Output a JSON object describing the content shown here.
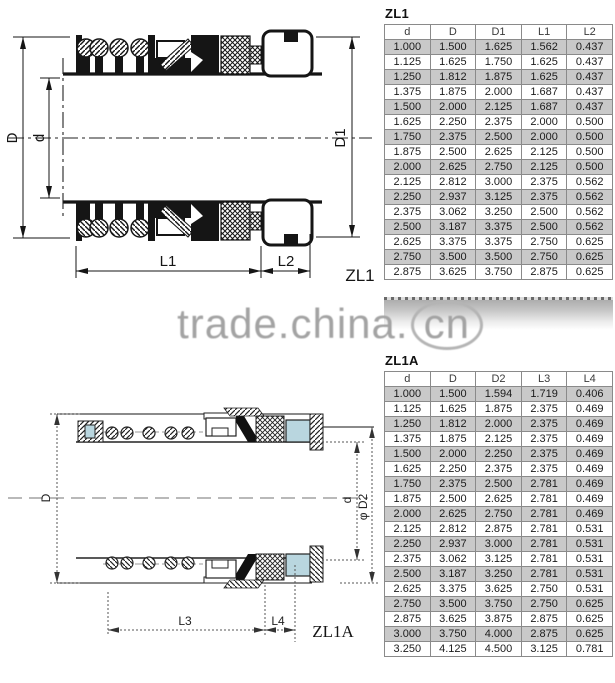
{
  "watermark": {
    "prefix": "trade.china.",
    "suffix": "cn"
  },
  "colors": {
    "row_shade": "#c9c9c9",
    "table_border": "#8a8a8a",
    "seat_blue": "#b9d6df",
    "watermark_gray": "#a3a3a3",
    "line_black": "#151515"
  },
  "zl1": {
    "title": "ZL1",
    "drawing": {
      "label": "ZL1",
      "dim_outer_diameter": "D",
      "dim_shaft_diameter": "d",
      "dim_seat_diameter": "D1",
      "dim_length1": "L1",
      "dim_length2": "L2"
    },
    "table": {
      "headers": [
        "d",
        "D",
        "D1",
        "L1",
        "L2"
      ],
      "rows": [
        [
          "1.000",
          "1.500",
          "1.625",
          "1.562",
          "0.437"
        ],
        [
          "1.125",
          "1.625",
          "1.750",
          "1.625",
          "0.437"
        ],
        [
          "1.250",
          "1.812",
          "1.875",
          "1.625",
          "0.437"
        ],
        [
          "1.375",
          "1.875",
          "2.000",
          "1.687",
          "0.437"
        ],
        [
          "1.500",
          "2.000",
          "2.125",
          "1.687",
          "0.437"
        ],
        [
          "1.625",
          "2.250",
          "2.375",
          "2.000",
          "0.500"
        ],
        [
          "1.750",
          "2.375",
          "2.500",
          "2.000",
          "0.500"
        ],
        [
          "1.875",
          "2.500",
          "2.625",
          "2.125",
          "0.500"
        ],
        [
          "2.000",
          "2.625",
          "2.750",
          "2.125",
          "0.500"
        ],
        [
          "2.125",
          "2.812",
          "3.000",
          "2.375",
          "0.562"
        ],
        [
          "2.250",
          "2.937",
          "3.125",
          "2.375",
          "0.562"
        ],
        [
          "2.375",
          "3.062",
          "3.250",
          "2.500",
          "0.562"
        ],
        [
          "2.500",
          "3.187",
          "3.375",
          "2.500",
          "0.562"
        ],
        [
          "2.625",
          "3.375",
          "3.375",
          "2.750",
          "0.625"
        ],
        [
          "2.750",
          "3.500",
          "3.500",
          "2.750",
          "0.625"
        ],
        [
          "2.875",
          "3.625",
          "3.750",
          "2.875",
          "0.625"
        ]
      ]
    }
  },
  "zl1a": {
    "title": "ZL1A",
    "drawing": {
      "label": "ZL1A",
      "dim_outer_diameter": "D",
      "dim_shaft_diameter": "d",
      "dim_seat_diameter": "φ D2",
      "dim_length3": "L3",
      "dim_length4": "L4"
    },
    "table": {
      "headers": [
        "d",
        "D",
        "D2",
        "L3",
        "L4"
      ],
      "rows": [
        [
          "1.000",
          "1.500",
          "1.594",
          "1.719",
          "0.406"
        ],
        [
          "1.125",
          "1.625",
          "1.875",
          "2.375",
          "0.469"
        ],
        [
          "1.250",
          "1.812",
          "2.000",
          "2.375",
          "0.469"
        ],
        [
          "1.375",
          "1.875",
          "2.125",
          "2.375",
          "0.469"
        ],
        [
          "1.500",
          "2.000",
          "2.250",
          "2.375",
          "0.469"
        ],
        [
          "1.625",
          "2.250",
          "2.375",
          "2.375",
          "0.469"
        ],
        [
          "1.750",
          "2.375",
          "2.500",
          "2.781",
          "0.469"
        ],
        [
          "1.875",
          "2.500",
          "2.625",
          "2.781",
          "0.469"
        ],
        [
          "2.000",
          "2.625",
          "2.750",
          "2.781",
          "0.469"
        ],
        [
          "2.125",
          "2.812",
          "2.875",
          "2.781",
          "0.531"
        ],
        [
          "2.250",
          "2.937",
          "3.000",
          "2.781",
          "0.531"
        ],
        [
          "2.375",
          "3.062",
          "3.125",
          "2.781",
          "0.531"
        ],
        [
          "2.500",
          "3.187",
          "3.250",
          "2.781",
          "0.531"
        ],
        [
          "2.625",
          "3.375",
          "3.625",
          "2.750",
          "0.531"
        ],
        [
          "2.750",
          "3.500",
          "3.750",
          "2.750",
          "0.625"
        ],
        [
          "2.875",
          "3.625",
          "3.875",
          "2.875",
          "0.625"
        ],
        [
          "3.000",
          "3.750",
          "4.000",
          "2.875",
          "0.625"
        ],
        [
          "3.250",
          "4.125",
          "4.500",
          "3.125",
          "0.781"
        ]
      ]
    }
  }
}
